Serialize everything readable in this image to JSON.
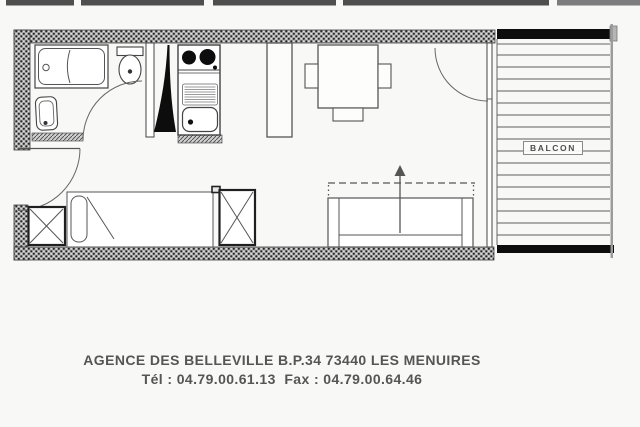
{
  "plan": {
    "balcony_label": "BALCON"
  },
  "footer": {
    "line1": "AGENCE DES BELLEVILLE B.P.34 73440 LES MENUIRES",
    "line2": "Tél : 04.79.00.61.13  Fax : 04.79.00.64.46"
  },
  "colors": {
    "paper": "#f8f8f6",
    "ink": "#4a4a4a",
    "footer-text": "#555555"
  },
  "drawing_colors": {
    "wall_hatch_gray": "#ababab",
    "wall_hatch_dot": "#262626",
    "solid_black_fill": "#0d0d0d",
    "line_gray": "#555555",
    "balcony_edge_gray": "#9c9c9c"
  }
}
